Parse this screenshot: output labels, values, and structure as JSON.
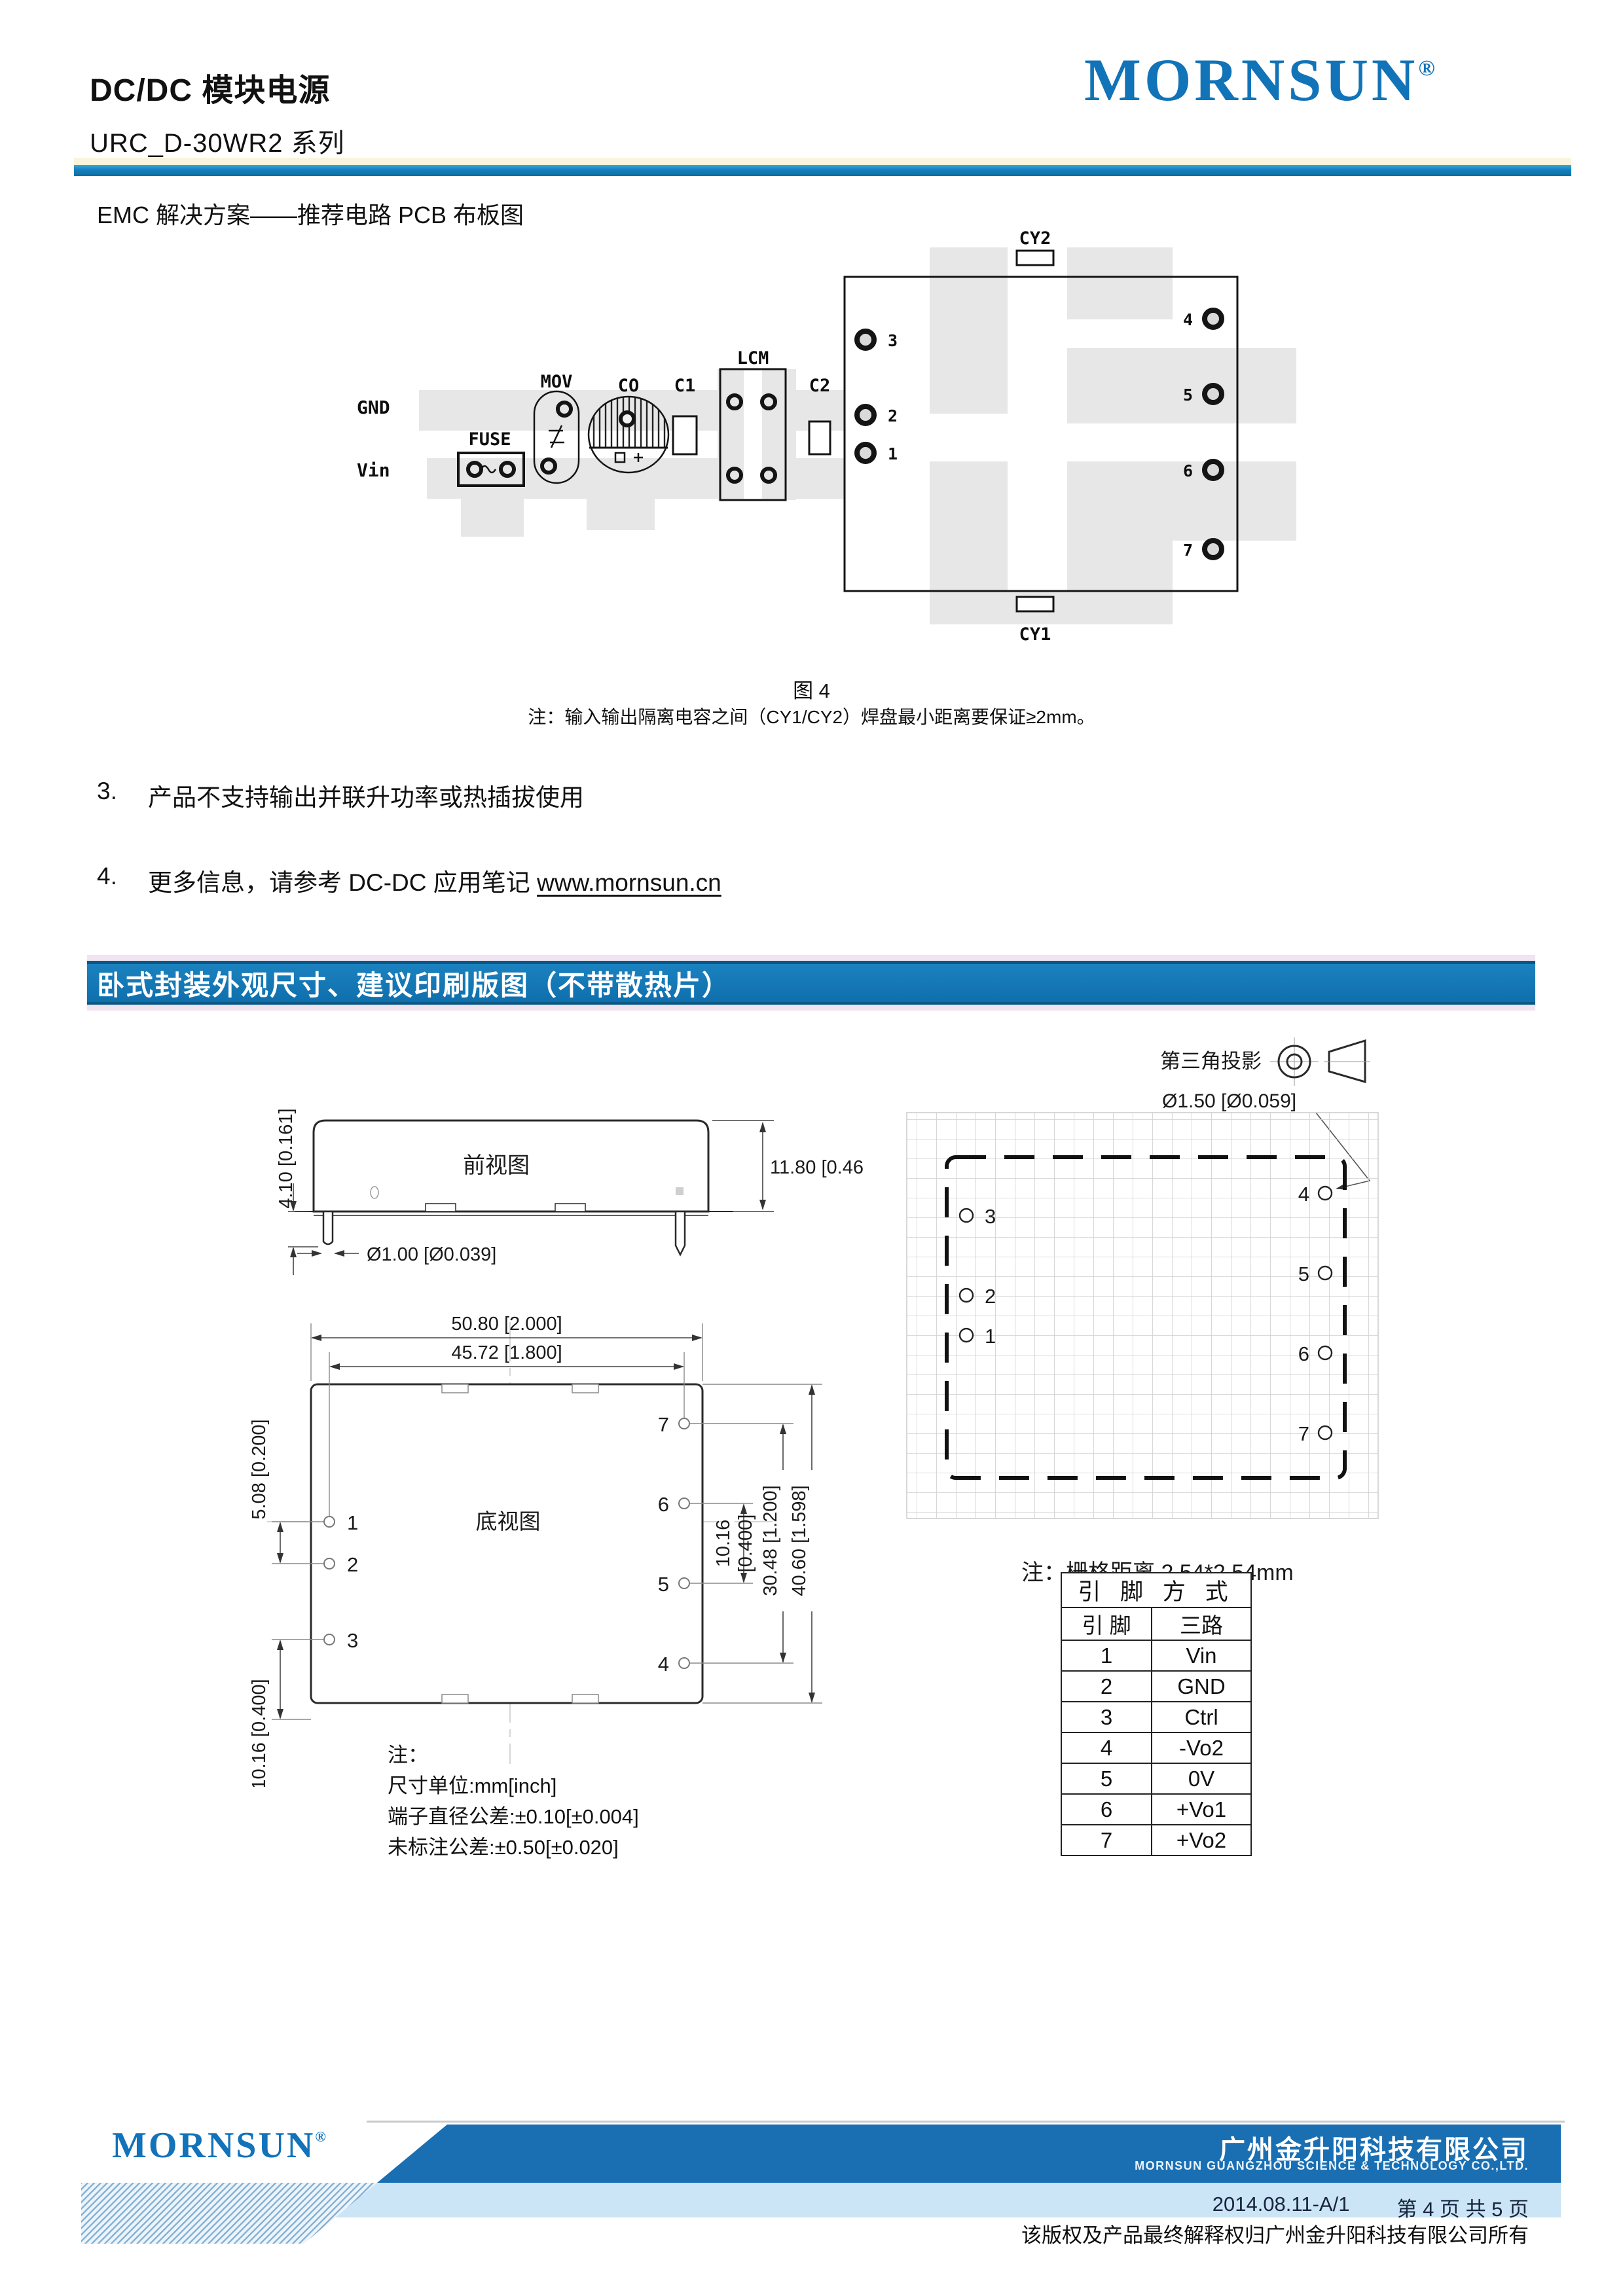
{
  "colors": {
    "brand_blue": "#1173B8",
    "banner_blue": "#1274B4",
    "footer_dark_blue": "#1A6FB3",
    "footer_light_blue": "#CBE4F6",
    "divider_cream": "#FBF4DC"
  },
  "header": {
    "title": "DC/DC 模块电源",
    "series": "URC_D-30WR2 系列",
    "brand": "MORNSUN",
    "registered": "®"
  },
  "emc": {
    "heading": "EMC 解决方案——推荐电路 PCB 布板图",
    "labels": {
      "gnd": "GND",
      "vin": "Vin",
      "fuse": "FUSE",
      "mov": "MOV",
      "co": "CO",
      "c1": "C1",
      "lcm": "LCM",
      "c2": "C2",
      "cy2": "CY2",
      "cy1": "CY1"
    },
    "pins_left": [
      "3",
      "2",
      "1"
    ],
    "pins_right": [
      "4",
      "5",
      "6",
      "7"
    ],
    "caption": "图 4",
    "note": "注：输入输出隔离电容之间（CY1/CY2）焊盘最小距离要保证≥2mm。"
  },
  "remarks": {
    "item3_num": "3.",
    "item3": "产品不支持输出并联升功率或热插拔使用",
    "item4_num": "4.",
    "item4": "更多信息，请参考 DC-DC 应用笔记 ",
    "item4_link": "www.mornsun.cn"
  },
  "section": {
    "title": "卧式封装外观尺寸、建议印刷版图（不带散热片）"
  },
  "front_view": {
    "label": "前视图",
    "dim_pin_len": "4.10 [0.161]",
    "dim_height": "11.80 [0.465]",
    "dim_pin_dia": "Ø1.00 [Ø0.039]"
  },
  "bottom_view": {
    "label": "底视图",
    "dim_w_outer": "50.80 [2.000]",
    "dim_w_inner": "45.72 [1.800]",
    "dim_l_top": "5.08 [0.200]",
    "dim_l_bottom": "10.16 [0.400]",
    "dim_r_inner_a": "10.16",
    "dim_r_inner_b": "[0.400]",
    "dim_r_mid": "30.48 [1.200]",
    "dim_r_outer": "40.60 [1.598]",
    "pins_left": [
      "1",
      "2",
      "3"
    ],
    "pins_right": [
      "7",
      "6",
      "5",
      "4"
    ]
  },
  "drawing_notes": {
    "title": "注：",
    "line1": "尺寸单位:mm[inch]",
    "line2": "端子直径公差:±0.10[±0.004]",
    "line3": "未标注公差:±0.50[±0.020]"
  },
  "projection": {
    "label": "第三角投影"
  },
  "pcb": {
    "hole_dia": "Ø1.50 [Ø0.059]",
    "grid_note": "注：栅格距离 2.54*2.54mm",
    "holes_left": [
      "3",
      "2",
      "1"
    ],
    "holes_right": [
      "4",
      "5",
      "6",
      "7"
    ]
  },
  "pin_table": {
    "title": "引 脚 方 式",
    "col_pin": "引 脚",
    "col_route": "三路",
    "rows": [
      [
        "1",
        "Vin"
      ],
      [
        "2",
        "GND"
      ],
      [
        "3",
        "Ctrl"
      ],
      [
        "4",
        "-Vo2"
      ],
      [
        "5",
        "0V"
      ],
      [
        "6",
        "+Vo1"
      ],
      [
        "7",
        "+Vo2"
      ]
    ]
  },
  "footer": {
    "brand": "MORNSUN",
    "registered": "®",
    "company_cn": "广州金升阳科技有限公司",
    "company_en": "MORNSUN GUANGZHOU SCIENCE & TECHNOLOGY CO.,LTD.",
    "version": "2014.08.11-A/1",
    "page": "第 4 页 共 5 页",
    "copyright": "该版权及产品最终解释权归广州金升阳科技有限公司所有"
  }
}
